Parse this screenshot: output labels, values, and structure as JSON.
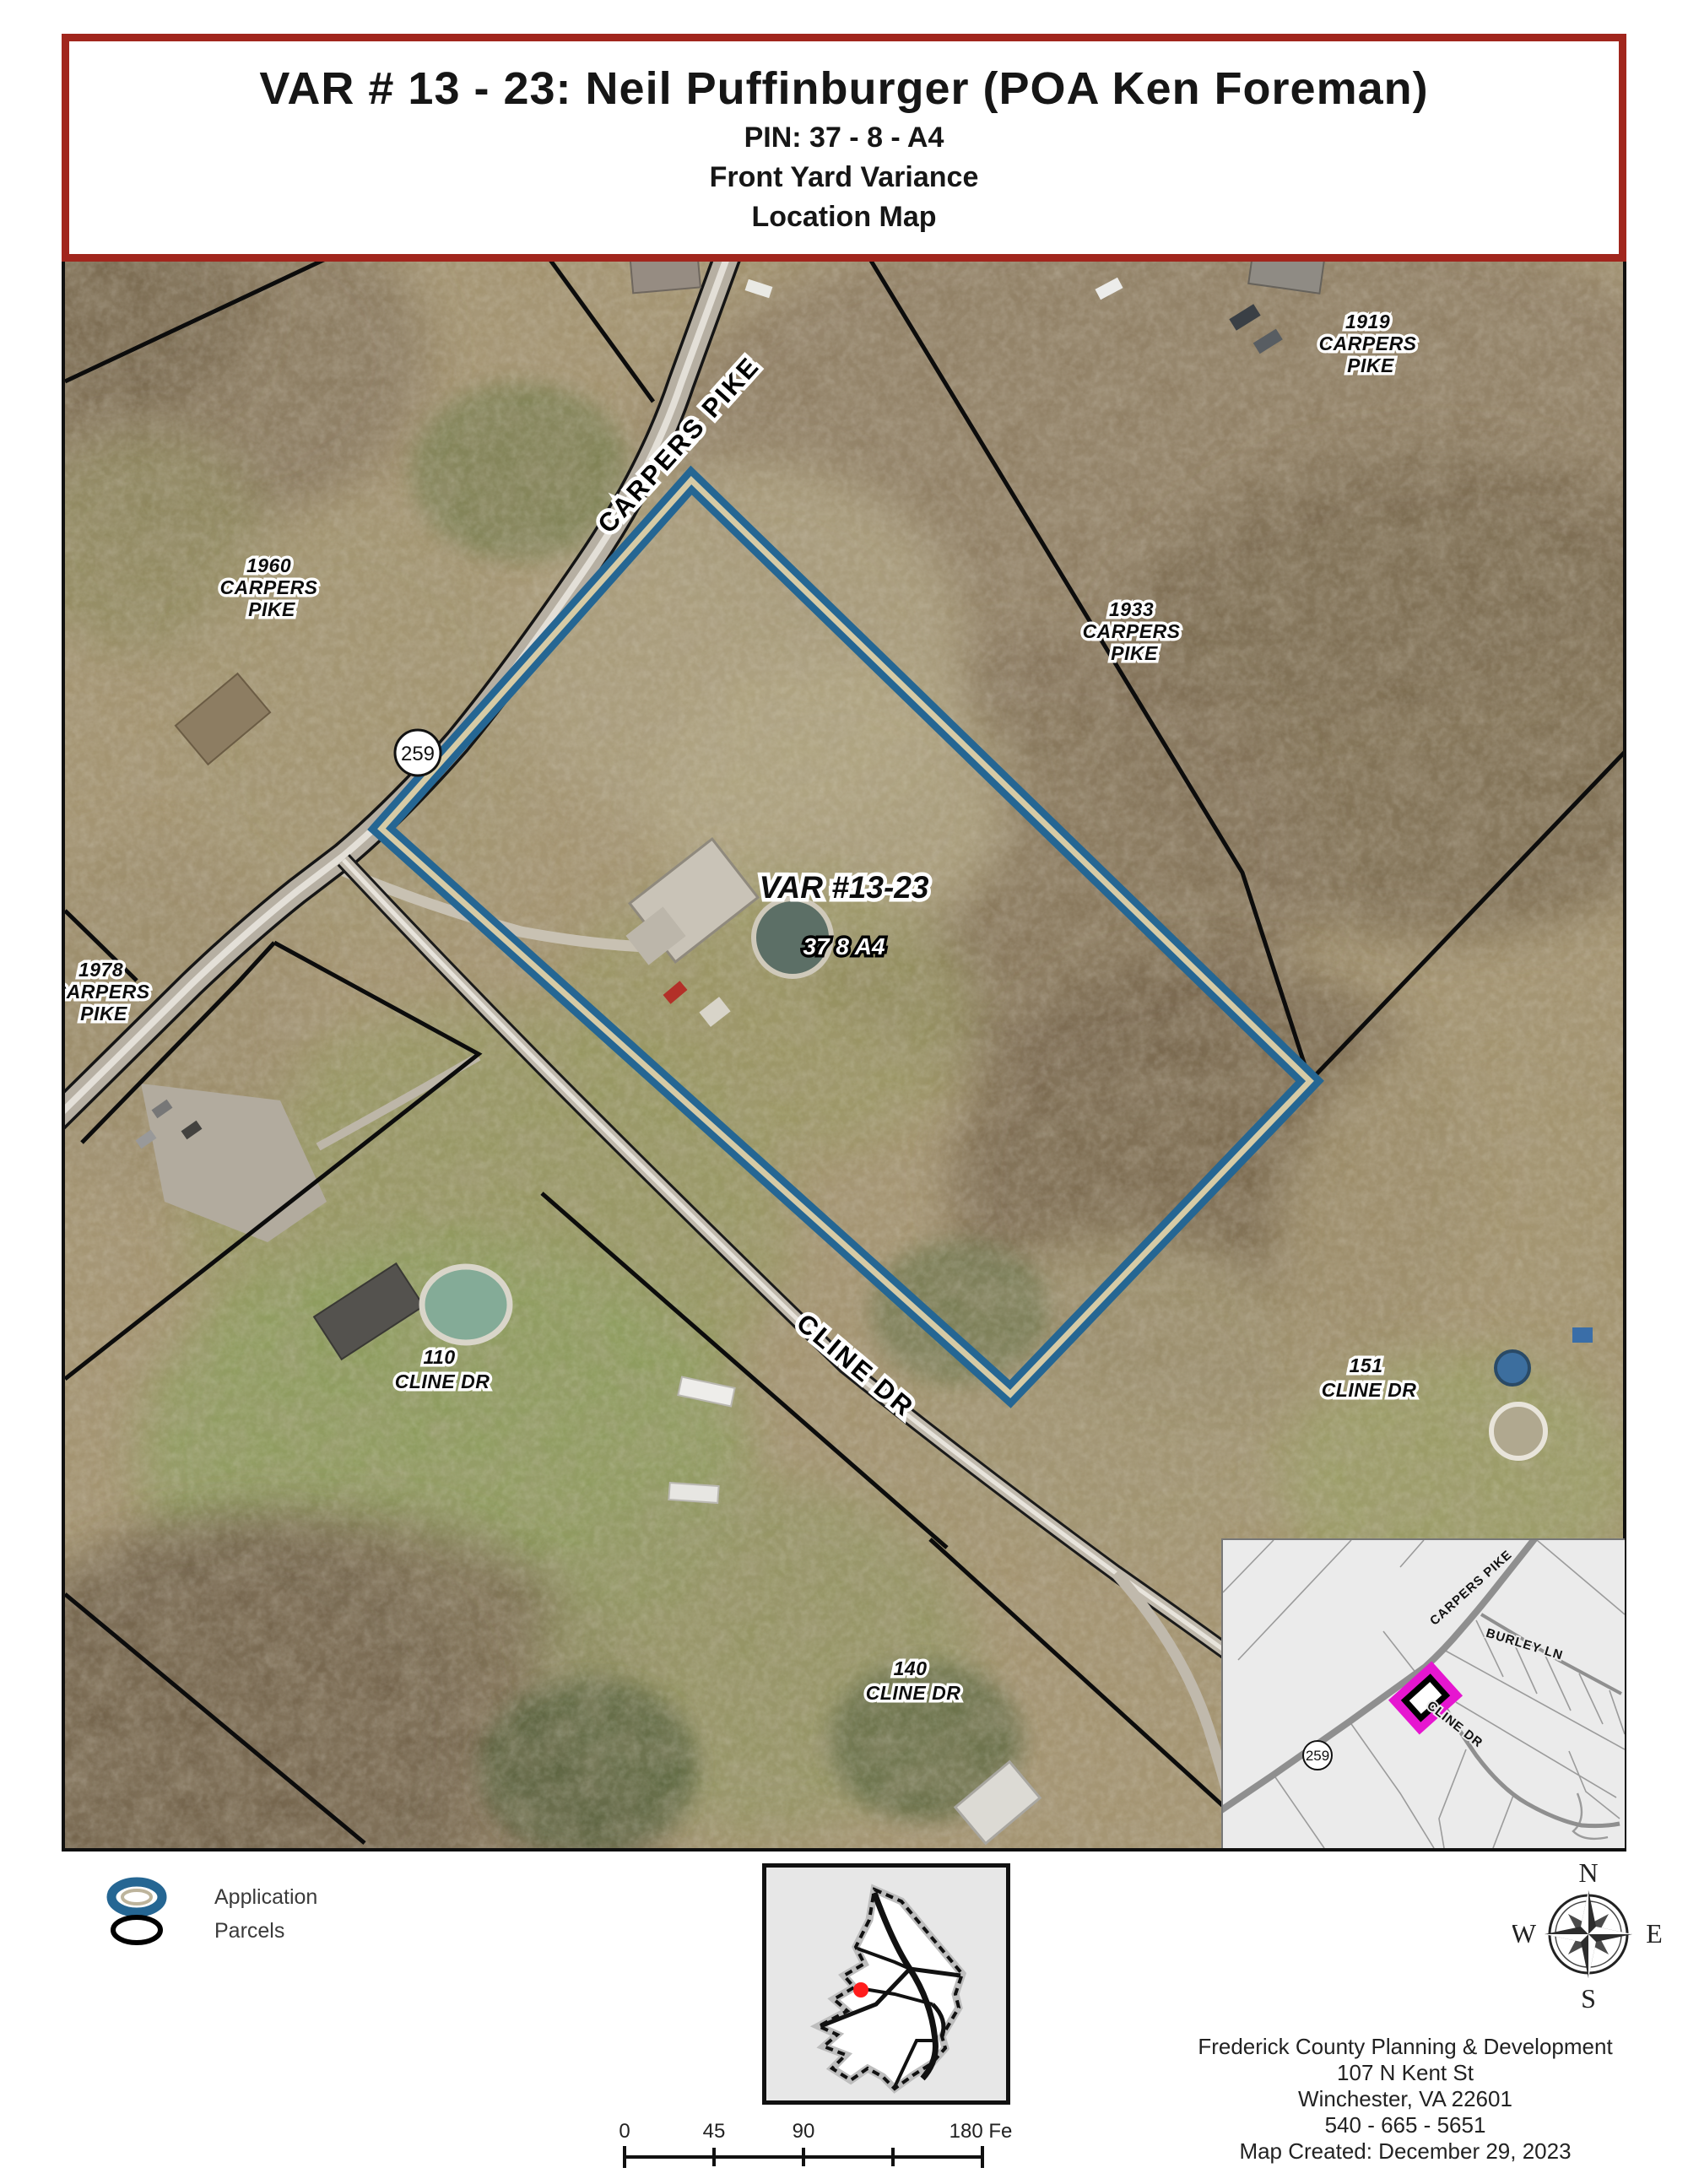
{
  "title": {
    "line1": "VAR # 13 - 23: Neil Puffinburger (POA Ken Foreman)",
    "line2": "PIN: 37 - 8 - A4",
    "line3": "Front Yard Variance",
    "line4": "Location Map"
  },
  "colors": {
    "title_border": "#a1261d",
    "application_outline_blue": "#256693",
    "application_outline_stripe": "#d6cba6",
    "inset_highlight_magenta": "#e616d0",
    "location_dot_red": "#ff1c1c"
  },
  "map": {
    "road_labels": {
      "carpers_pike": "CARPERS PIKE",
      "cline_dr": "CLINE DR"
    },
    "route_badge": "259",
    "subject": {
      "case_label": "VAR #13-23",
      "pin_label": "37 8 A4"
    },
    "parcel_labels": [
      {
        "id": "1960-carpers-pike",
        "lines": [
          "1960",
          "CARPERS",
          "PIKE"
        ]
      },
      {
        "id": "1919-carpers-pike",
        "lines": [
          "1919",
          "CARPERS",
          "PIKE"
        ]
      },
      {
        "id": "1933-carpers-pike",
        "lines": [
          "1933",
          "CARPERS",
          "PIKE"
        ]
      },
      {
        "id": "1978-carpers-pike",
        "lines": [
          "1978",
          "CARPERS",
          "PIKE"
        ]
      },
      {
        "id": "110-cline-dr",
        "lines": [
          "110",
          "CLINE DR"
        ]
      },
      {
        "id": "151-cline-dr",
        "lines": [
          "151",
          "CLINE DR"
        ]
      },
      {
        "id": "140-cline-dr",
        "lines": [
          "140",
          "CLINE DR"
        ]
      }
    ]
  },
  "inset": {
    "road_labels": {
      "carpers_pike": "CARPERS PIKE",
      "burley_ln": "BURLEY LN",
      "cline_dr": "CLINE DR"
    },
    "route_badge": "259"
  },
  "legend": {
    "items": [
      {
        "label": "Application"
      },
      {
        "label": "Parcels"
      }
    ]
  },
  "compass": {
    "n": "N",
    "e": "E",
    "s": "S",
    "w": "W"
  },
  "scalebar": {
    "ticks": [
      "0",
      "45",
      "90"
    ],
    "end_label": "180 Feet"
  },
  "footer": {
    "lines": [
      "Frederick County Planning & Development",
      "107 N Kent St",
      "Winchester, VA 22601",
      "540 - 665 - 5651",
      "Map Created: December 29, 2023"
    ]
  }
}
